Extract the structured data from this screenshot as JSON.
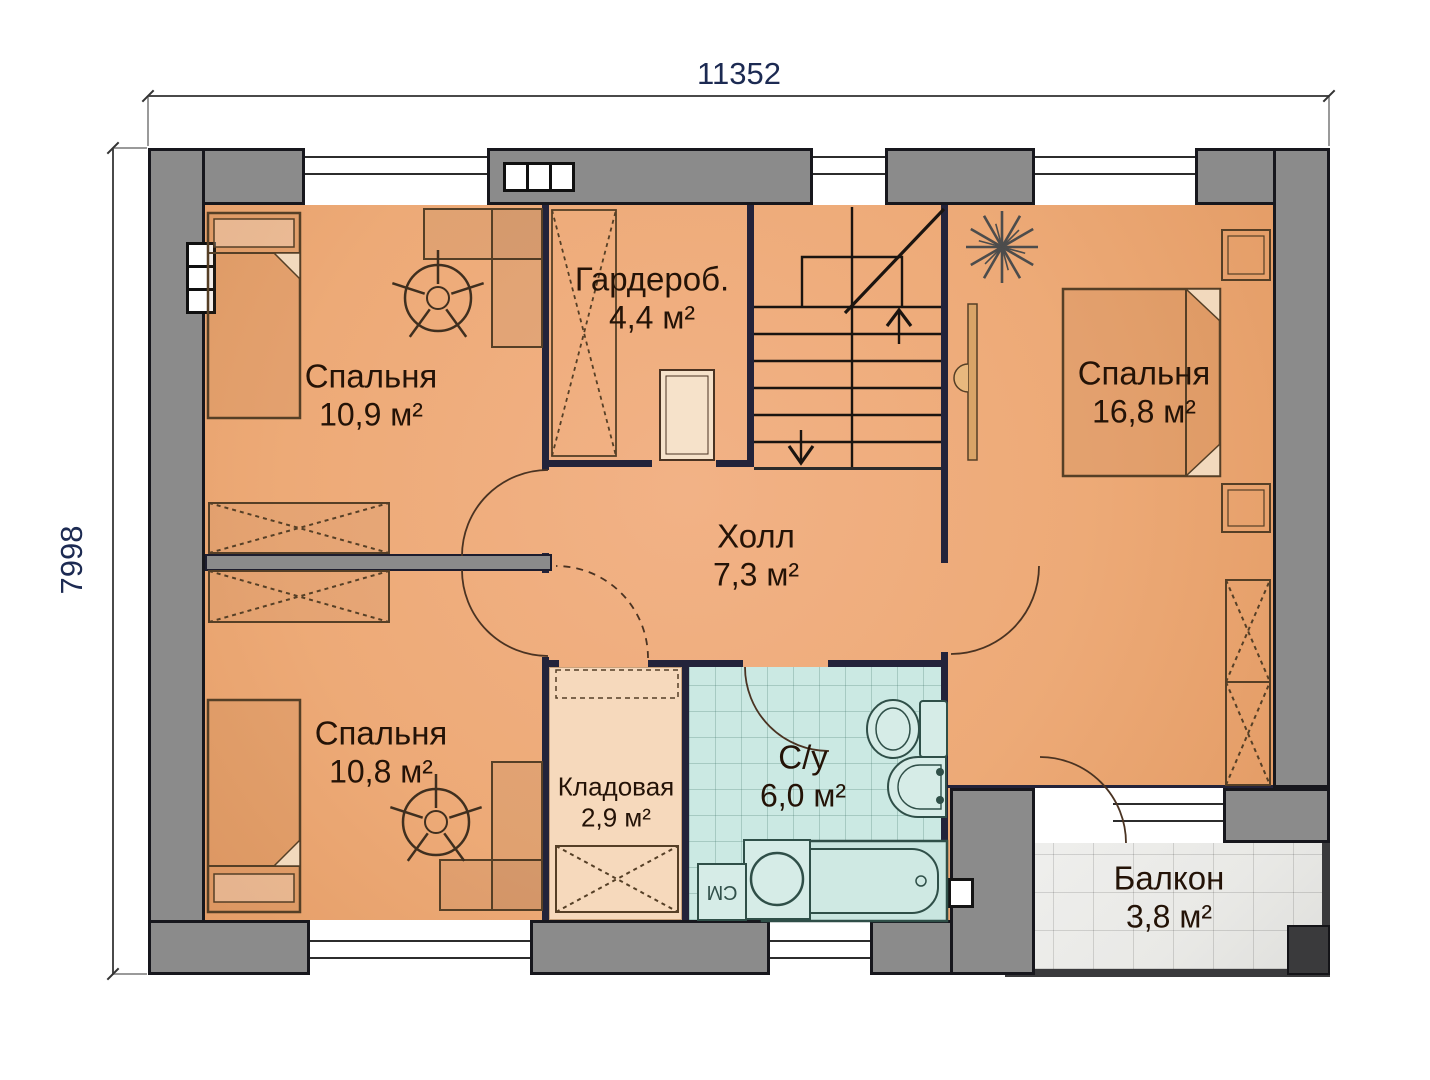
{
  "dimensions": {
    "top_mm": "11352",
    "left_mm": "7998"
  },
  "rooms": [
    {
      "id": "bedroom-top-left",
      "name": "Спальня",
      "area": "10,9 м²"
    },
    {
      "id": "wardrobe-room",
      "name": "Гардероб.",
      "area": "4,4 м²"
    },
    {
      "id": "bedroom-right",
      "name": "Спальня",
      "area": "16,8 м²"
    },
    {
      "id": "hall",
      "name": "Холл",
      "area": "7,3 м²"
    },
    {
      "id": "bedroom-bottom-left",
      "name": "Спальня",
      "area": "10,8 м²"
    },
    {
      "id": "storage",
      "name": "Кладовая",
      "area": "2,9 м²"
    },
    {
      "id": "bathroom",
      "name": "С/у",
      "area": "6,0 м²"
    },
    {
      "id": "balcony",
      "name": "Балкон",
      "area": "3,8 м²"
    }
  ],
  "annotations": {
    "washing_machine": "СМ"
  },
  "colors": {
    "floor": "#edaa77",
    "floor-light": "#f6d9bc",
    "wall": "#8b8b8b",
    "wall-border": "#17171d",
    "partition": "#23233a",
    "bath": "#cbe9e3",
    "balcony": "#e9e9e6",
    "dim": "#1c2a52",
    "label": "#241307"
  }
}
